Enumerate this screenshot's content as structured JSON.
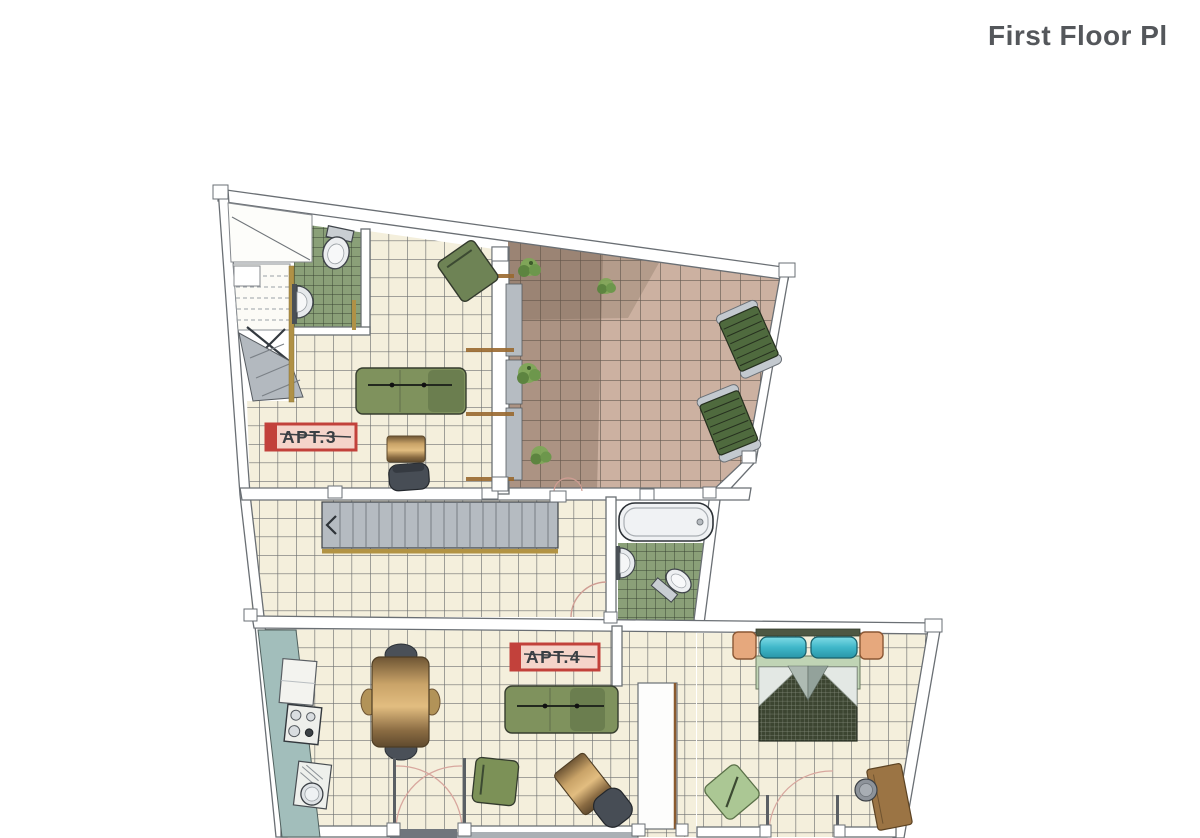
{
  "header": {
    "title": "First Floor Pl"
  },
  "plan": {
    "apartment_labels": [
      {
        "id": "apt-3",
        "text": "APT.3"
      },
      {
        "id": "apt-4",
        "text": "APT.4"
      }
    ],
    "rooms": [
      {
        "name": "stairwell-apt3"
      },
      {
        "name": "bathroom-apt3"
      },
      {
        "name": "living-room-apt3"
      },
      {
        "name": "terrace"
      },
      {
        "name": "stair-hallway"
      },
      {
        "name": "bathroom-apt4"
      },
      {
        "name": "kitchen-living-apt4"
      },
      {
        "name": "bedroom-apt4"
      }
    ],
    "furniture": [
      "toilet",
      "washbasin",
      "sofa",
      "armchair",
      "side-table",
      "chair",
      "staircase",
      "bathtub",
      "sun-lounger",
      "plant",
      "kitchen-counter",
      "stove",
      "kitchen-sink",
      "dining-table",
      "dining-chairs",
      "wardrobe",
      "double-bed",
      "nightstand",
      "bedroom-chair",
      "desk",
      "desk-chair"
    ],
    "colors": {
      "floor_tile": "#f4efdc",
      "bath_tile": "#8aa078",
      "terrace_tile": "#ccb1a1",
      "label_red": "#c2413b",
      "label_fill": "#f5d4ca",
      "sofa_green": "#7f925d",
      "kitchen_teal": "#a2bebb",
      "bed_pillow_cyan": "#54c6d6",
      "stair_gray": "#b5bbc1",
      "wood_tan": "#c9a368",
      "title_gray": "#54575b"
    }
  }
}
